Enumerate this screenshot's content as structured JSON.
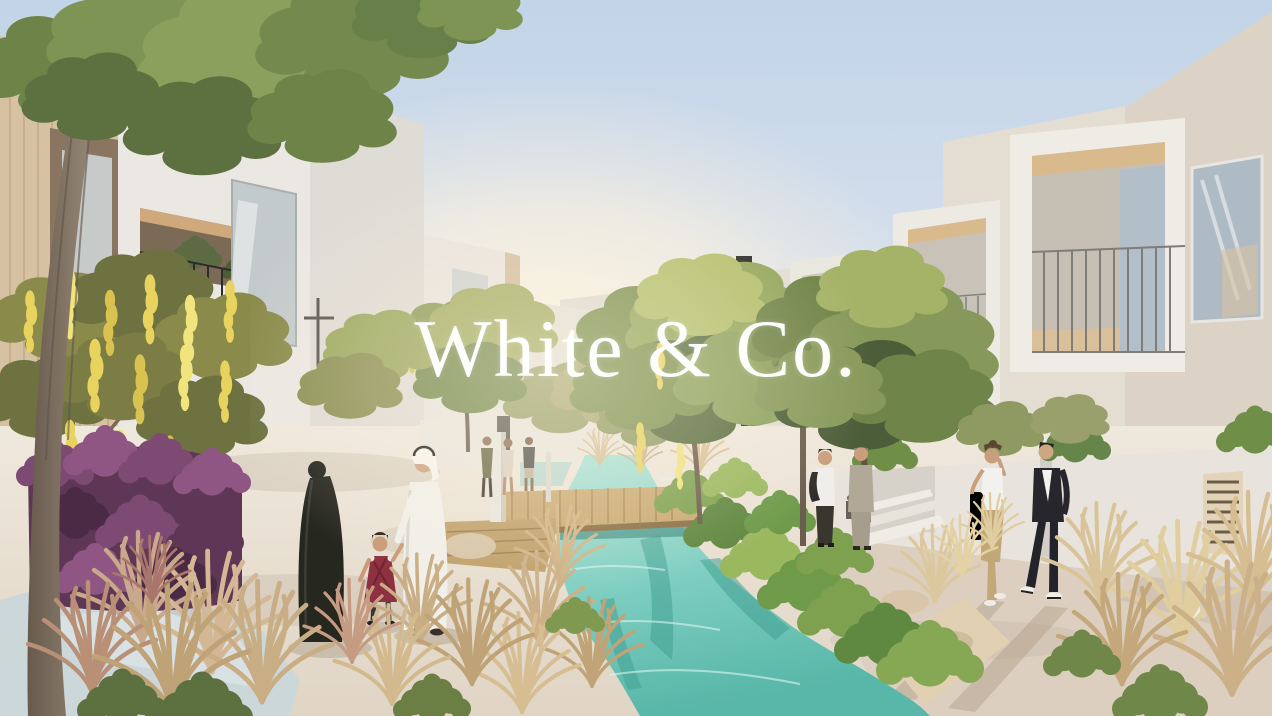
{
  "meta": {
    "kind": "architectural-rendering-photo",
    "width_px": 1272,
    "height_px": 716
  },
  "watermark": {
    "text": "White & Co."
  },
  "scene": {
    "description": "Sunlit render of a modern white villa community: turquoise stream with wooden boardwalk, landscaped grasses, a family in the foreground and residents strolling along the paths.",
    "people": [
      {
        "id": "woman-in-abaya",
        "detail": "black abaya"
      },
      {
        "id": "man-in-kandura",
        "detail": "white kandura and ghutra"
      },
      {
        "id": "child-in-red-dress",
        "detail": "dark red dress"
      },
      {
        "id": "woman-walking",
        "detail": "white top, khaki trousers"
      },
      {
        "id": "man-walking",
        "detail": "dark blazer, white tee"
      },
      {
        "id": "man-on-phone",
        "detail": "white shirt, jacket over shoulder"
      },
      {
        "id": "man-in-grey-suit",
        "detail": "grey suit"
      }
    ],
    "palette": {
      "sky_top": "#c2d4e8",
      "sun_glow": "#fff6e0",
      "building_white": "#ebe8e3",
      "building_warm": "#dcd3c6",
      "wood_accent": "#d6c1a2",
      "foliage_green": "#7c9150",
      "bloom_yellow": "#e8d35e",
      "bougainvillea_purple": "#74466a",
      "water_turquoise": "#7fcfc2",
      "boardwalk_wood": "#c9a972",
      "path_cool_blue": "#ccd7da",
      "path_warm": "#dccfc0",
      "grass_wheat": "#d2b98e"
    }
  }
}
